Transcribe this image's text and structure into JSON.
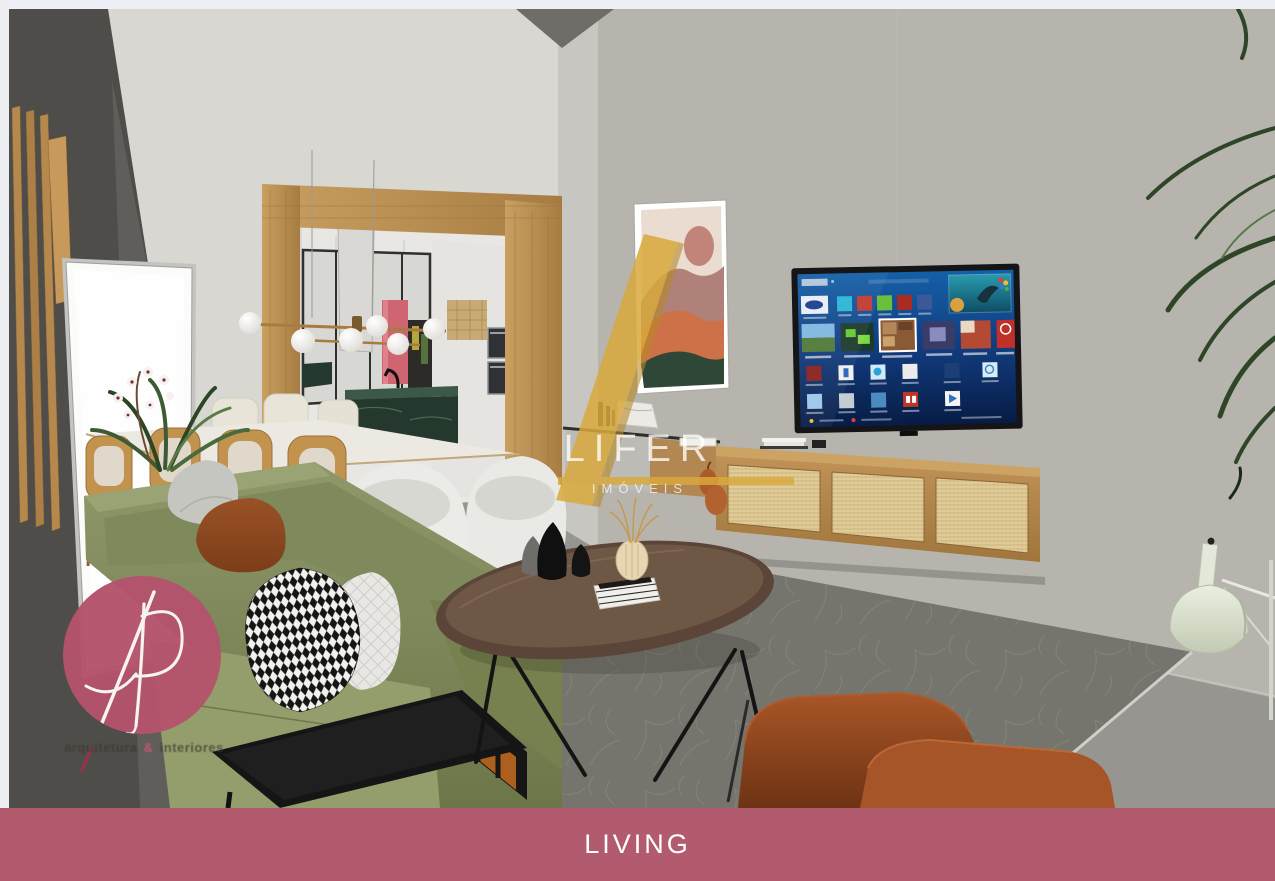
{
  "document": {
    "kind": "interior-design-render",
    "room_label": "LIVING"
  },
  "banner": {
    "label": "LIVING"
  },
  "watermark": {
    "brand": "LIFER",
    "subtitle": "IMÓVEIS"
  },
  "logo": {
    "monogram": "AP",
    "tagline": {
      "left": "arquitetura",
      "amp": "&",
      "right": "interiores"
    }
  },
  "scene": {
    "description": "3D architectural render of an open-plan living room with kitchen and dining area",
    "objects": [
      "olive-green sofa with pillows",
      "oval walnut coffee table",
      "black side table with wood frame",
      "rust armchair",
      "wall-mounted smart TV",
      "wood and cane floating TV console",
      "abstract landscape painting",
      "dining table with wooden and boucle chairs",
      "brass globe chandelier",
      "kitchen with green marble island and coral refrigerator",
      "white open door",
      "dark slatted wood wall",
      "palm plant",
      "sage dome floor lamp",
      "gray textured area rug"
    ]
  },
  "palette": {
    "banner-bg": "#b25a6e",
    "banner-text": "#ffffff",
    "logo-pink": "#b4536b",
    "gold": "#d9a93c",
    "wall-light": "#d8d7d2",
    "wall-right": "#b6b4ad",
    "wall-dark": "#4e4d49",
    "floor": "#96958f",
    "rug": "#76756d",
    "wood": "#bb9055",
    "cane": "#e2cd9b",
    "door": "#fbfbfa",
    "sofa-green": "#87905f",
    "pillow-rust": "#8d4a24",
    "armchair-rust": "#9c4c26",
    "marble-green": "#25382e",
    "coral": "#cf6570",
    "lamp-sage": "#e0e7d6",
    "tv-blue": "#0d2f6e",
    "painting-cream": "#eadcd0",
    "painting-terracotta": "#cd7149",
    "painting-green": "#2f4736",
    "painting-mauve": "#b08178",
    "painting-sun": "#c08578"
  }
}
